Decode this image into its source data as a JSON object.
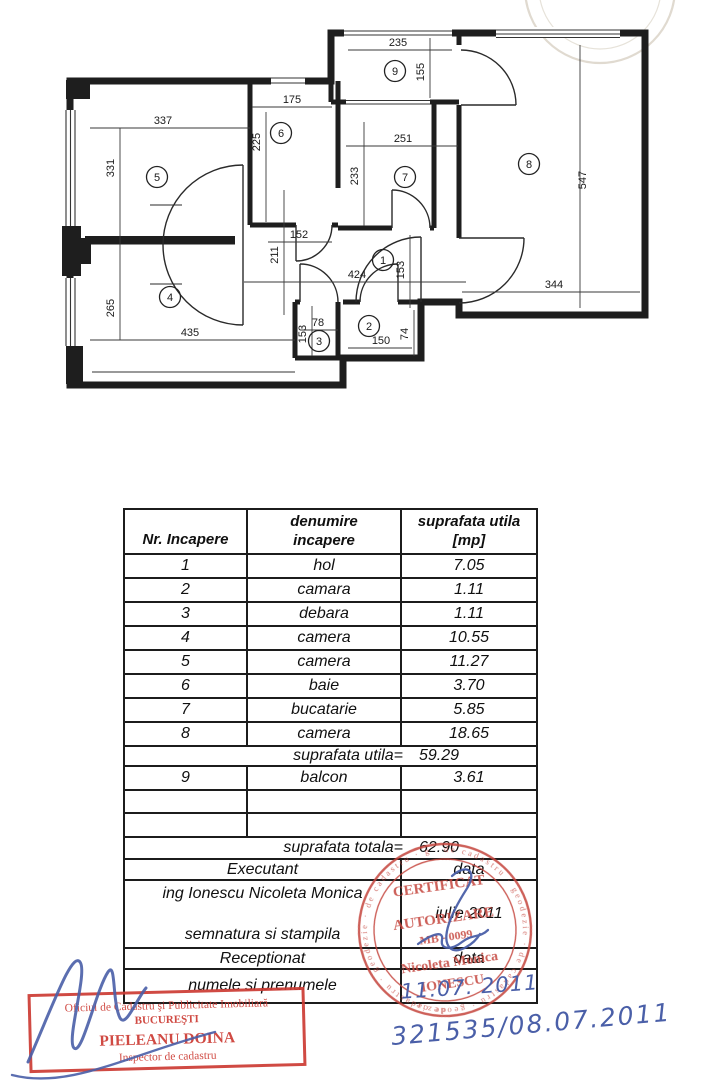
{
  "floor_plan": {
    "room_numbers": [
      "1",
      "2",
      "3",
      "4",
      "5",
      "6",
      "7",
      "8",
      "9"
    ],
    "dimensions": {
      "room5_width": "337",
      "room5_height": "331",
      "room6_width": "175",
      "room6_height": "225",
      "balcony_width": "235",
      "balcony_height": "155",
      "room7_width": "251",
      "room7_height": "233",
      "room8_width": "344",
      "room8_height": "547",
      "hall_width": "424",
      "hall_height": "153",
      "corridor_width": "152",
      "corridor_length": "211",
      "room4_width": "435",
      "room4_height": "265",
      "room3_width": "78",
      "room3_height": "153",
      "room2_width": "150",
      "room2_height": "74"
    }
  },
  "table": {
    "header": {
      "col1": "Nr. Incapere",
      "col2_line1": "denumire",
      "col2_line2": "incapere",
      "col3_line1": "suprafata utila",
      "col3_line2": "[mp]"
    },
    "rows": [
      {
        "nr": "1",
        "name": "hol",
        "area": "7.05"
      },
      {
        "nr": "2",
        "name": "camara",
        "area": "1.11"
      },
      {
        "nr": "3",
        "name": "debara",
        "area": "1.11"
      },
      {
        "nr": "4",
        "name": "camera",
        "area": "10.55"
      },
      {
        "nr": "5",
        "name": "camera",
        "area": "11.27"
      },
      {
        "nr": "6",
        "name": "baie",
        "area": "3.70"
      },
      {
        "nr": "7",
        "name": "bucatarie",
        "area": "5.85"
      },
      {
        "nr": "8",
        "name": "camera",
        "area": "18.65"
      }
    ],
    "subtotal": {
      "label": "suprafata utila=",
      "value": "59.29"
    },
    "balcony_row": {
      "nr": "9",
      "name": "balcon",
      "area": "3.61"
    },
    "total": {
      "label": "suprafata totala=",
      "value": "62.90"
    },
    "executant": {
      "label": "Executant",
      "data_label": "data",
      "name": "ing Ionescu Nicoleta Monica",
      "signature_label": "semnatura si stampila",
      "date": "iulie 2011"
    },
    "receptionat": {
      "label": "Receptionat",
      "data_label": "data",
      "name_label": "numele si prenumele"
    }
  },
  "stamps": {
    "round": {
      "color": "#c4433b",
      "line1": "CERTIFICAT",
      "line2": "AUTORIZARE",
      "line3": "MB - 0099",
      "name_line1": "Nicoleta Monica",
      "name_line2": "IONESCU",
      "ring_text": "de cadastru · geodezie · de cadastru · geodezie ·"
    },
    "rect": {
      "color": "#cc3b33",
      "line1": "Oficiul de Cadastru şi Publicitate Imobiliară",
      "line2": "BUCUREŞTI",
      "line3": "PIELEANU DOINA",
      "line4": "Inspector de cadastru"
    }
  },
  "handwriting": {
    "ink_color": "#4a5fa8",
    "receptionat_date": "11.07. 2011",
    "registration_number": "321535/08.07.2011"
  }
}
